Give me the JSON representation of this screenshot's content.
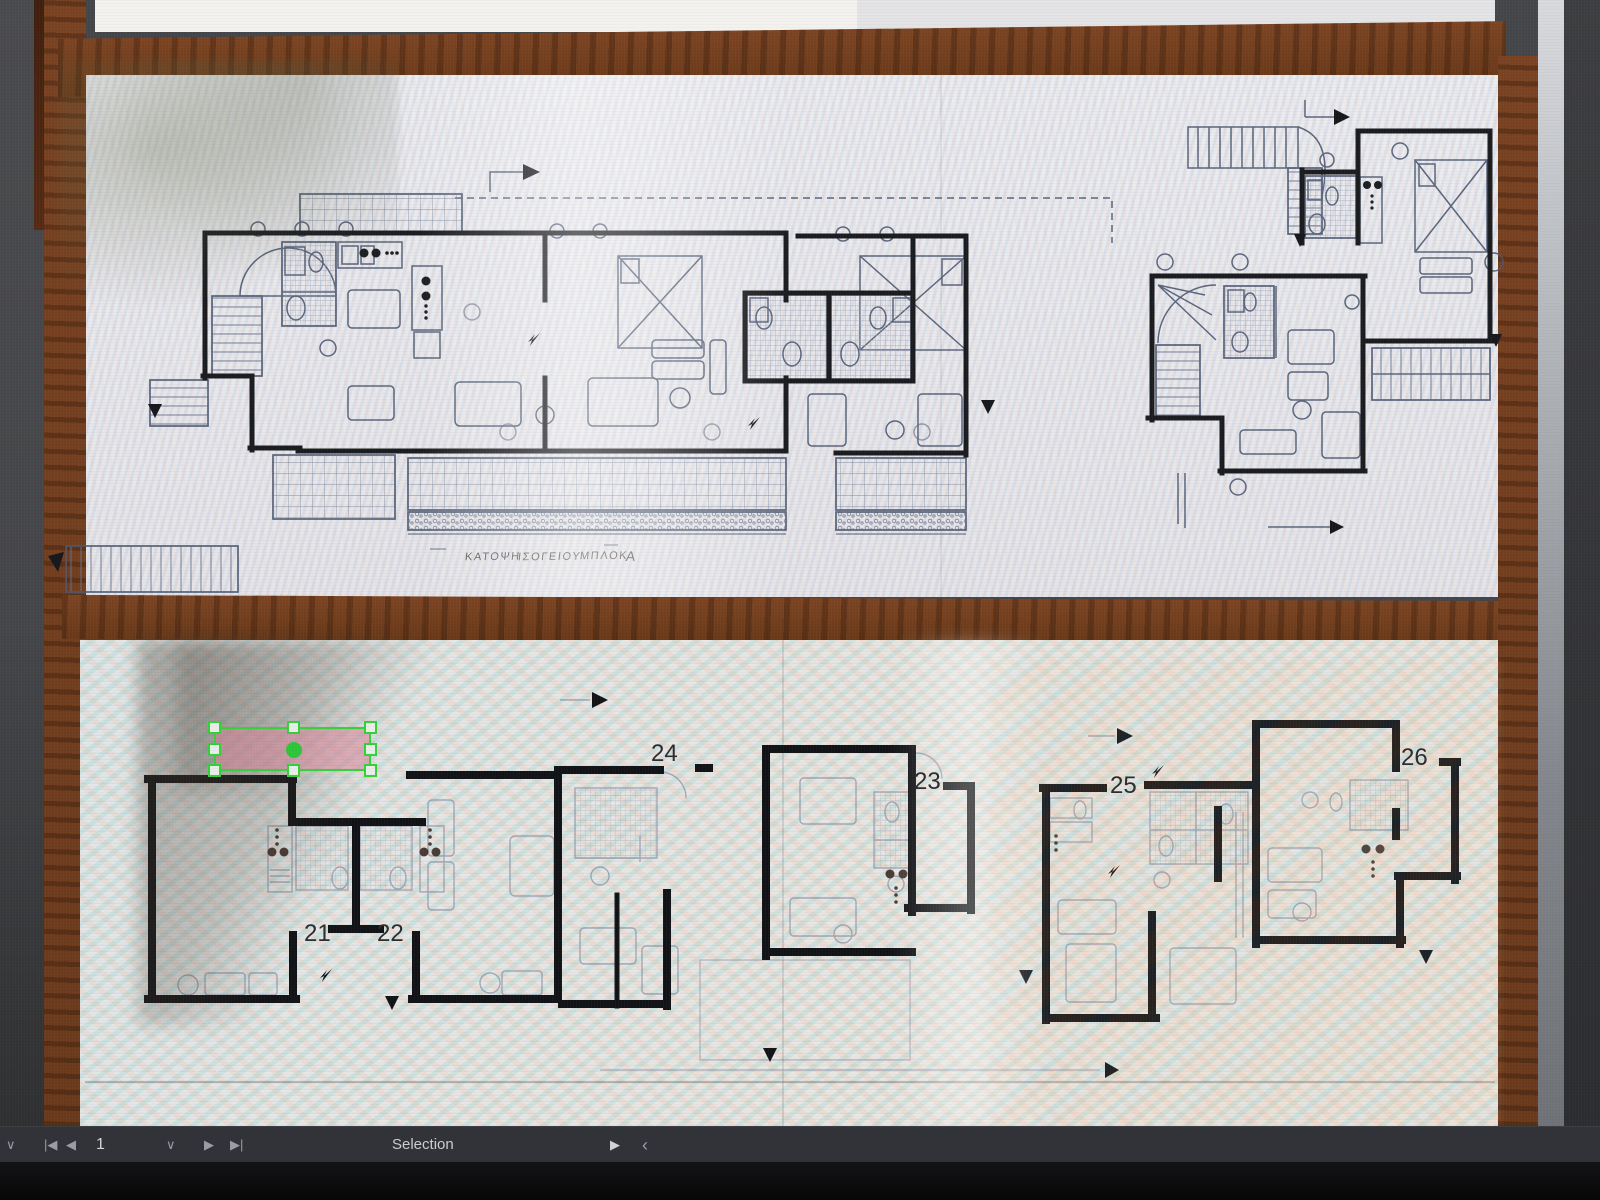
{
  "toolbar": {
    "page_value": "1",
    "mode_label": "Selection",
    "icons": [
      "chevron-down",
      "first-page",
      "previous-page",
      "page-dropdown-chevron",
      "next-page",
      "last-page",
      "play-next",
      "back-chevron"
    ],
    "bg_color": "#313338"
  },
  "annotations": {
    "unit_labels": [
      {
        "text": "21"
      },
      {
        "text": "22"
      },
      {
        "text": "23"
      },
      {
        "text": "24"
      },
      {
        "text": "25"
      },
      {
        "text": "26"
      }
    ],
    "selection": {
      "fill_color": "rgba(219,128,152,0.5)",
      "accent_color": "#35d03c"
    }
  },
  "document": {
    "caption_words": [
      "ΚΑΤΟΨΗ",
      "ΙΣΟΓΕΙΟΥ",
      "ΜΠΛΟΚ",
      "Α"
    ]
  },
  "colors": {
    "canvas_bg": "#454649",
    "wood": "#74421f",
    "paper": "#e9e9eb",
    "ink_bold": "#17181b",
    "ink_light": "#4d5870"
  }
}
